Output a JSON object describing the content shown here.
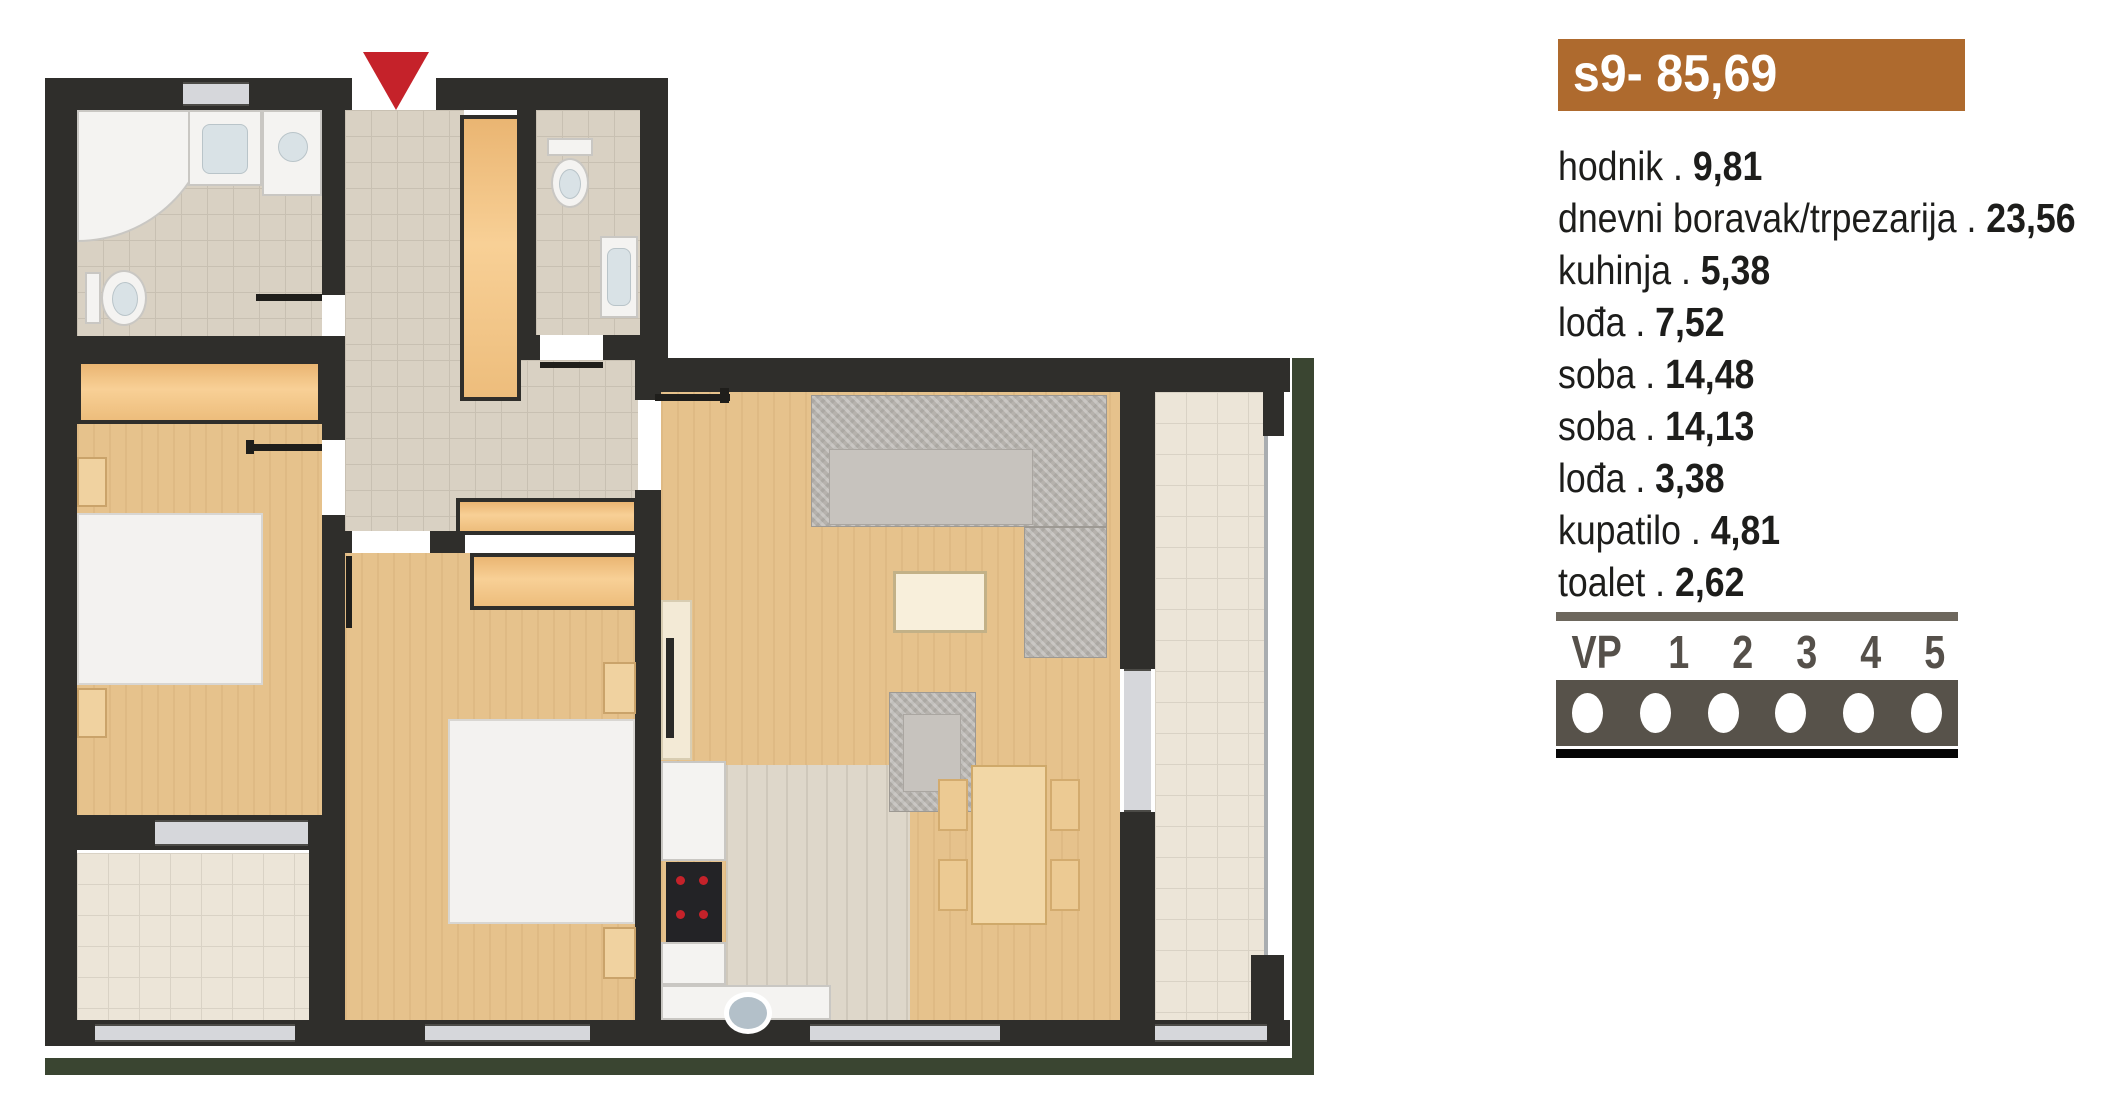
{
  "colors": {
    "wall": "#2f2e2b",
    "ink": "#1d1d1b",
    "accent": "#ae6a2e",
    "wood": "#e6c28c",
    "tile": "#d9d1c3",
    "tile-line": "#c8c0b2",
    "loggia": "#ece5d8",
    "loggia-line": "#d9d2c5",
    "kitchen-floor": "#ded7ca",
    "kitchen-line": "#cfc8bb",
    "marble": "#d6d7db",
    "green": "#3a4531",
    "red": "#c5222a",
    "sofa": "#b6b2ad",
    "white-furn": "#f4f3f1",
    "furn-edge": "#c9c7c3",
    "cream": "#f2d7a6",
    "chair": "#ecca93",
    "vp-dark": "#57524a",
    "vp-mid": "#6d675d",
    "vp-num": "#55504a"
  },
  "panel": {
    "title": "s9- 85,69",
    "sep": " . ",
    "rooms": [
      {
        "name": "hodnik",
        "area": "9,81"
      },
      {
        "name": "dnevni boravak/trpezarija",
        "area": "23,56"
      },
      {
        "name": "kuhinja",
        "area": "5,38"
      },
      {
        "name": "lođa",
        "area": "7,52"
      },
      {
        "name": "soba",
        "area": "14,48"
      },
      {
        "name": "soba",
        "area": "14,13"
      },
      {
        "name": "lođa",
        "area": "3,38"
      },
      {
        "name": "kupatilo",
        "area": "4,81"
      },
      {
        "name": "toalet",
        "area": "2,62"
      }
    ],
    "floor_indicator": {
      "labels": [
        "VP",
        "1",
        "2",
        "3",
        "4",
        "5"
      ]
    }
  },
  "plan": {
    "entrance_marker": "red-down-arrow"
  }
}
